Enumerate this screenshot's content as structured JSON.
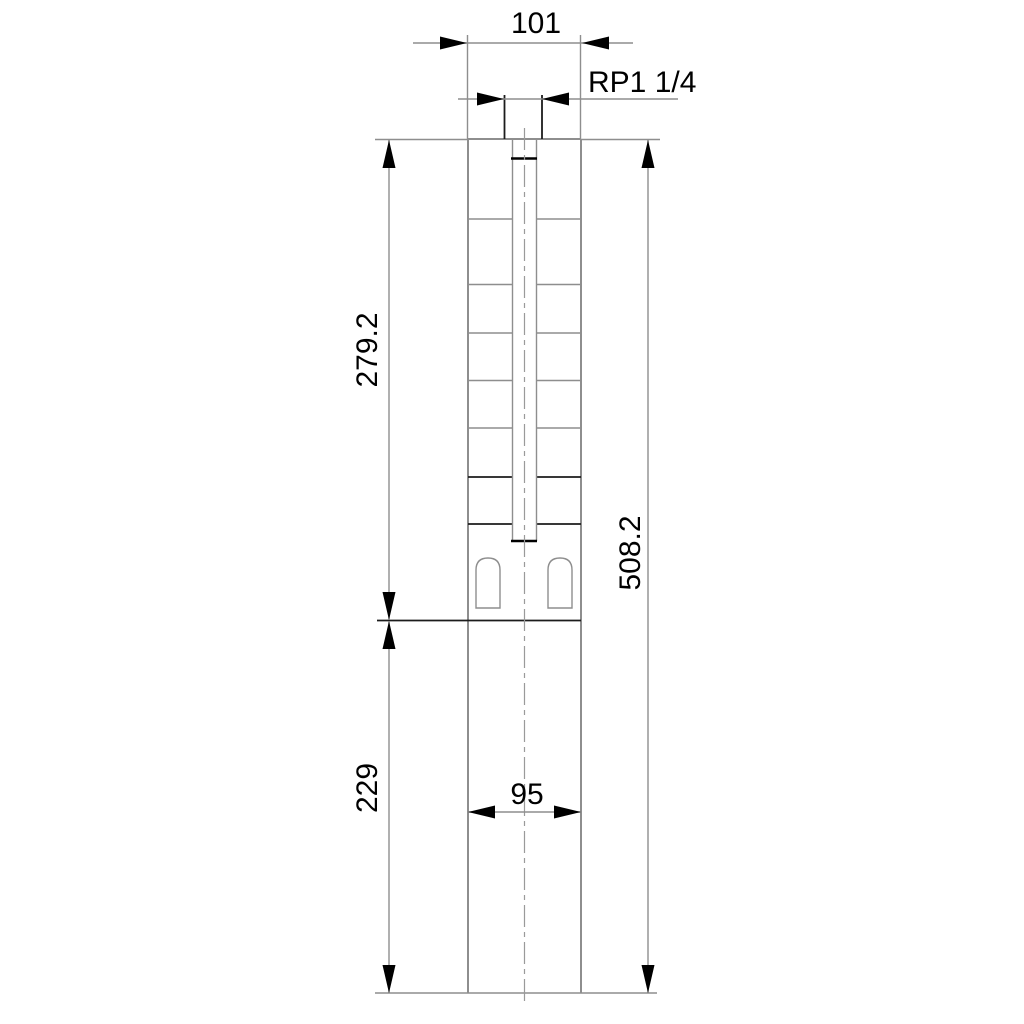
{
  "drawing": {
    "type": "technical-dimension-drawing",
    "subject": "submersible-borehole-pump-outline",
    "background_color": "#ffffff",
    "line_color_gray": "#8e8e8e",
    "line_color_black": "#000000",
    "dimensions": {
      "top_width": "101",
      "thread": "RP1 1/4",
      "upper_section_height": "279.2",
      "total_height": "508.2",
      "lower_section_height": "229",
      "lower_width": "95"
    }
  }
}
